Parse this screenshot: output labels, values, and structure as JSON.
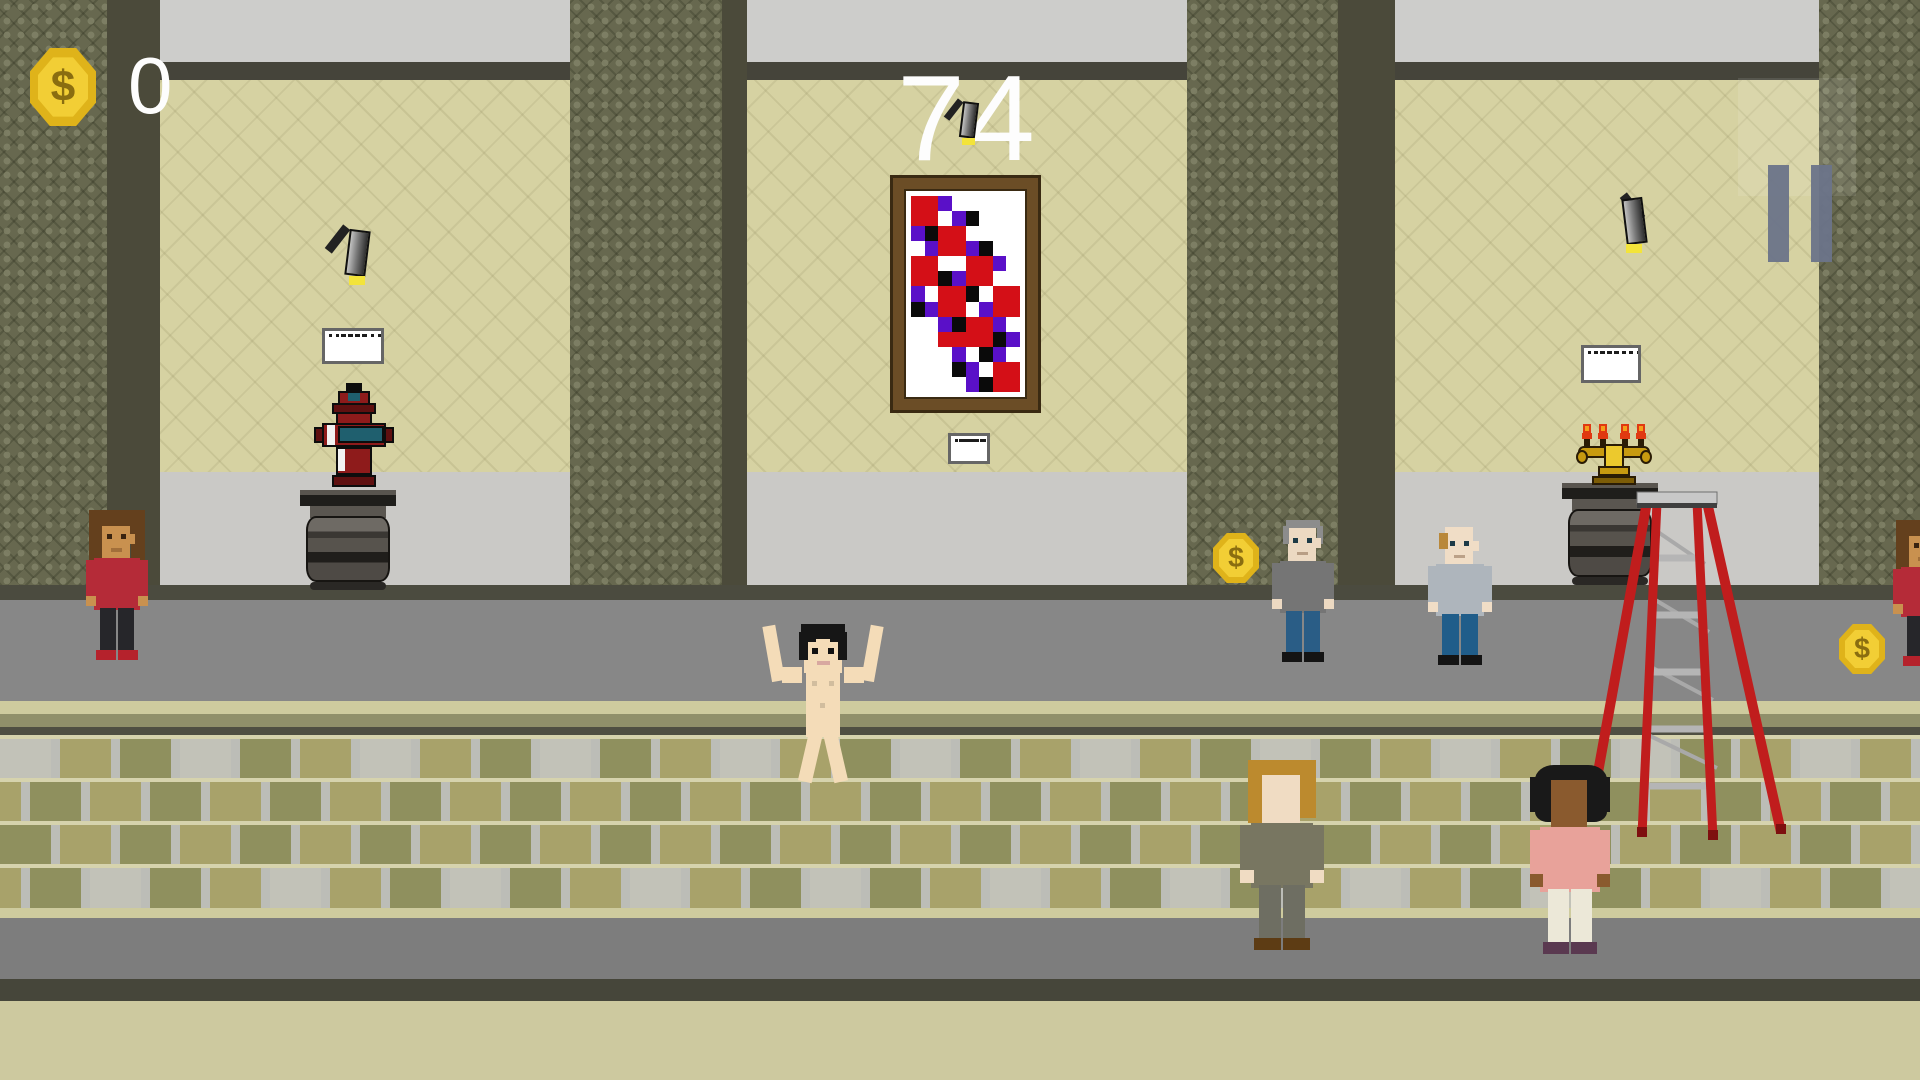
{
  "hud": {
    "coin_count": "0",
    "timer": "74",
    "coin_icon": "dollar-coin-icon",
    "pause_icon": "pause-icon",
    "accent_gold": "#e8bc1f",
    "text_color": "#fdfdfd"
  },
  "palette": {
    "ceiling": "#cdcdcb",
    "crown_band": "#45443a",
    "wall_beige": "#d6d2a2",
    "wall_lower_gray": "#cac9c6",
    "baseline_dark": "#4b4b3f",
    "walkway_upper": "#878787",
    "step_highlight": "#cecb9e",
    "step_mid": "#90906a",
    "step_shadow": "#4f4f42",
    "tile_olive": "#8f905e",
    "tile_khaki": "#a8a26a",
    "tile_light": "#c2c2b8",
    "tile_grout": "#bcbdb7",
    "tile_row_line": "#d6d3ad",
    "walkway_lower": "#7d7d7d",
    "bottom_dark": "#46463a",
    "bottom_khaki": "#cdc99f",
    "column_base": "#67684f",
    "column_shade": "#4b4a3a"
  },
  "scene": {
    "columns": [
      {
        "x": 0,
        "w": 107,
        "shade_w": 53
      },
      {
        "x": 570,
        "w": 152,
        "shade_w": 25
      },
      {
        "x": 1187,
        "w": 151,
        "shade_w": 57
      },
      {
        "x": 1819,
        "w": 101,
        "shade_w": 0
      }
    ],
    "painting": {
      "x": 893,
      "y": 178,
      "w": 145,
      "h": 232,
      "frame": "#6b4d26",
      "frame_dark": "#3a2a12",
      "canvas": "#ffffff",
      "colors": {
        "R": "#d40f17",
        "P": "#5a10c8",
        "K": "#0a0a0a",
        "W": "#ffffff"
      },
      "grid": [
        "RRPWWWWW",
        "RRWPKWWW",
        "PKRRWWWW",
        "WPRRPKWW",
        "RRWWRRPW",
        "RRKPRRWW",
        "PWRRKWRR",
        "KPRRWPRR",
        "WWPKRRPW",
        "WWRRRRKP",
        "WWWPWKPW",
        "WWWKPWRR",
        "WWWWPKRR"
      ]
    },
    "placards": [
      {
        "id": "placard-hydrant",
        "x": 322,
        "y": 328,
        "w": 62,
        "h": 36
      },
      {
        "id": "placard-painting",
        "x": 948,
        "y": 433,
        "w": 42,
        "h": 31
      },
      {
        "id": "placard-candelabra",
        "x": 1581,
        "y": 345,
        "w": 60,
        "h": 38
      }
    ],
    "spotlights": [
      {
        "id": "spotlight-left",
        "x": 333,
        "y": 222,
        "scale": 1.0,
        "dir": 1
      },
      {
        "id": "spotlight-center",
        "x": 950,
        "y": 96,
        "scale": 0.78,
        "dir": 1
      },
      {
        "id": "spotlight-right",
        "x": 1610,
        "y": 190,
        "scale": 1.0,
        "dir": -1
      }
    ],
    "pedestals": [
      {
        "id": "pedestal-hydrant",
        "x": 300,
        "y": 490,
        "w": 96,
        "h": 100
      },
      {
        "id": "pedestal-candelabra",
        "x": 1562,
        "y": 483,
        "w": 96,
        "h": 102
      }
    ],
    "hydrant": {
      "x": 312,
      "y": 383,
      "w": 84,
      "h": 110,
      "body": "#8e1b1b",
      "dark": "#5f1010",
      "band": "#1f5f6e",
      "outline": "#0d0d0d",
      "highlight": "#f2f2f2"
    },
    "candelabra": {
      "x": 1576,
      "y": 424,
      "w": 76,
      "h": 62,
      "gold": "#c79a10",
      "gold_light": "#ecc92d",
      "gold_dark": "#7c5c06",
      "flame": "#e03911",
      "flame_core": "#f5a01a"
    },
    "ladder": {
      "x": 1585,
      "y": 490,
      "w": 200,
      "h": 350,
      "red": "#c01d1d",
      "red_dark": "#7e0f0f",
      "step": "#b5b5b5",
      "cap": "#c8c8c8",
      "cap_dark": "#3f3f3f"
    },
    "coins": [
      {
        "id": "coin-walkway-left",
        "x": 1213,
        "y": 533,
        "s": 46
      },
      {
        "id": "coin-walkway-right",
        "x": 1839,
        "y": 624,
        "s": 46
      }
    ],
    "characters": [
      {
        "id": "visitor-woman-red",
        "label": "woman visitor in red shirt",
        "x": 86,
        "y": 508,
        "w": 62,
        "h": 160,
        "facing": "front",
        "pose": "stand",
        "hair": "long-curly",
        "colors": {
          "skin": "#c9914f",
          "hair": "#64401d",
          "shirt": "#b52b38",
          "pants": "#26262a",
          "shoes": "#b5222c",
          "eyes": "#3a2410"
        }
      },
      {
        "id": "streaker",
        "label": "naked streaker with arms up",
        "x": 768,
        "y": 623,
        "w": 110,
        "h": 166,
        "facing": "front",
        "pose": "arms-up",
        "hair": "short-top",
        "colors": {
          "skin": "#f4dcb8",
          "hair": "#161616",
          "mouth": "#d8a8a0",
          "eyes": "#111111"
        }
      },
      {
        "id": "visitor-man-gray",
        "label": "gray-haired man in gray sweater",
        "x": 1272,
        "y": 512,
        "w": 62,
        "h": 158,
        "facing": "front",
        "pose": "stand",
        "hair": "gray-sides",
        "colors": {
          "skin": "#ecd9c2",
          "hair": "#8c8c8c",
          "shirt": "#757575",
          "pants": "#2a5d86",
          "shoes": "#141414",
          "eyes": "#1d3a46"
        }
      },
      {
        "id": "visitor-man-balding",
        "label": "balding man in light sweater",
        "x": 1428,
        "y": 515,
        "w": 64,
        "h": 158,
        "facing": "front",
        "pose": "stand",
        "hair": "balding-blond",
        "colors": {
          "skin": "#f0ddc6",
          "hair": "#b9883a",
          "shirt": "#aeb5bc",
          "pants": "#205d8a",
          "shoes": "#141414",
          "eyes": "#1d3a46"
        }
      },
      {
        "id": "visitor-man-blond-back",
        "label": "blond man seen from behind",
        "x": 1240,
        "y": 760,
        "w": 84,
        "h": 200,
        "facing": "back",
        "pose": "stand",
        "hair": "full-blond",
        "colors": {
          "skin": "#f0dcc3",
          "hair": "#bc8a2e",
          "shirt": "#787661",
          "pants": "#6e6e62",
          "shoes": "#5d3c14"
        }
      },
      {
        "id": "visitor-person-pink-back",
        "label": "person in pink seen from behind",
        "x": 1530,
        "y": 765,
        "w": 80,
        "h": 199,
        "facing": "back",
        "pose": "stand",
        "hair": "afro",
        "colors": {
          "skin": "#8a5a2e",
          "hair": "#191919",
          "shirt": "#e8a29a",
          "pants": "#ece8d8",
          "shoes": "#5a3950"
        }
      },
      {
        "id": "visitor-woman-edge",
        "label": "woman visitor at right edge (partial)",
        "x": 1893,
        "y": 518,
        "w": 62,
        "h": 156,
        "facing": "front",
        "pose": "stand",
        "hair": "long-curly",
        "colors": {
          "skin": "#c9914f",
          "hair": "#64401d",
          "shirt": "#b52b38",
          "pants": "#26262a",
          "shoes": "#b5222c",
          "eyes": "#3a2410"
        }
      }
    ]
  }
}
